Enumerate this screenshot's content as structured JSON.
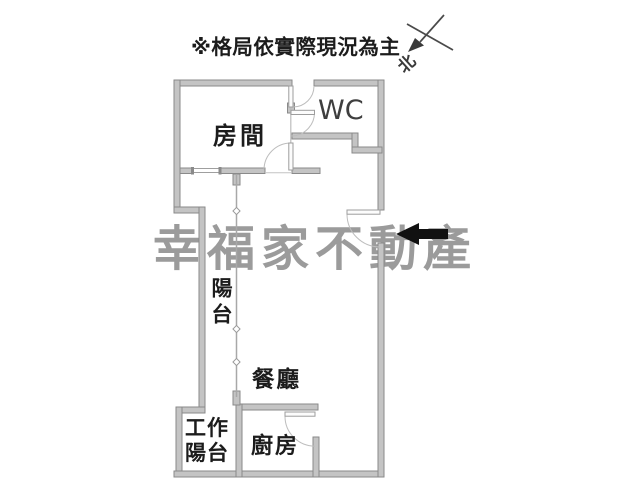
{
  "disclaimer": {
    "text": "※格局依實際現況為主"
  },
  "compass": {
    "north_label": "北"
  },
  "watermark": {
    "text": "幸福家不動產",
    "color": "#9b9b9b"
  },
  "floor_plan": {
    "rooms": {
      "bedroom": {
        "label": "房間"
      },
      "wc": {
        "label": "WC"
      },
      "balcony": {
        "label": "陽台"
      },
      "dining": {
        "label": "餐廳"
      },
      "kitchen": {
        "label": "廚房"
      },
      "work_balcony": {
        "label_lines": [
          "工作",
          "陽台"
        ]
      }
    },
    "colors": {
      "wall_fill": "#c4c4c4",
      "wall_edge": "#8a8a8a",
      "door_line": "#bdbdbd",
      "entrance_arrow": "#111111",
      "label_text": "#1c1c1c",
      "watermark": "#9b9b9b"
    }
  }
}
